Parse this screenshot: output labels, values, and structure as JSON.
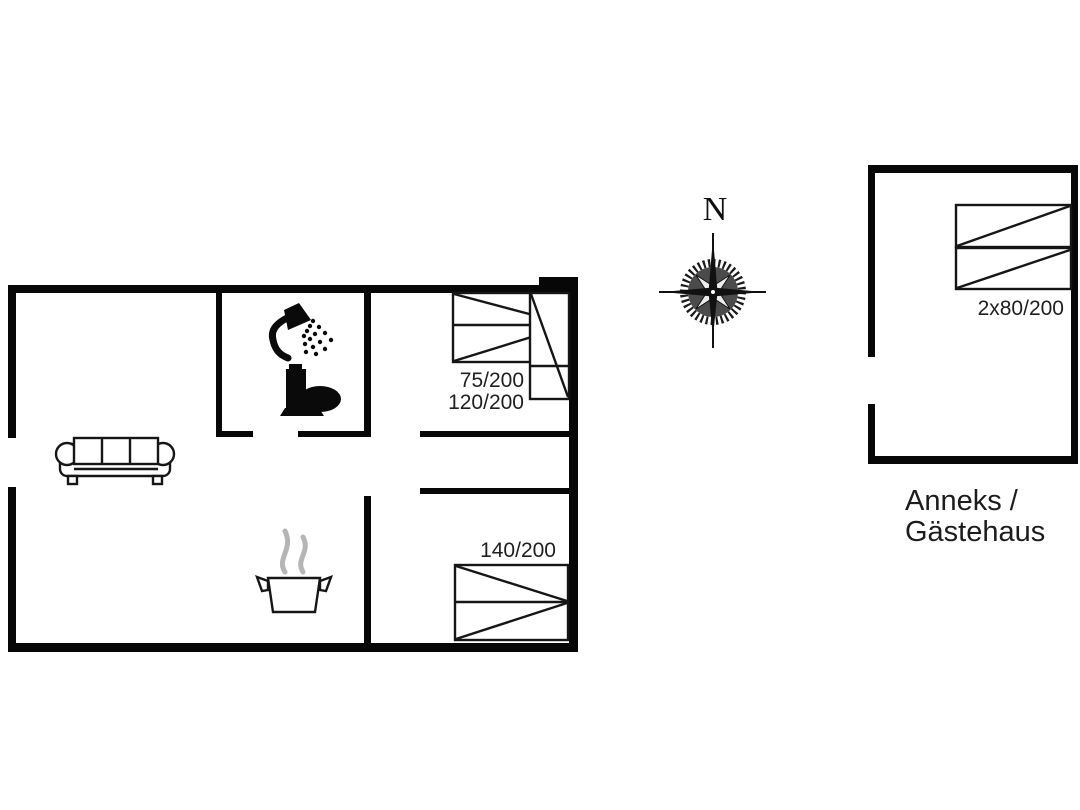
{
  "compass": {
    "north_label": "N"
  },
  "main_house": {
    "bedroom1": {
      "bed_labels": [
        "75/200",
        "120/200"
      ]
    },
    "bedroom2": {
      "bed_label": "140/200"
    }
  },
  "annex": {
    "bed_label": "2x80/200",
    "caption": [
      "Anneks /",
      "Gästehaus"
    ]
  },
  "icons": {
    "bathroom": [
      "shower-icon",
      "toilet-icon"
    ],
    "kitchen": [
      "cooking-pot-icon",
      "steam-icon"
    ],
    "living_room": [
      "sofa-icon"
    ],
    "navigation": [
      "compass-rose-icon"
    ]
  },
  "colors": {
    "background": "#ffffff",
    "wall": "#070707",
    "line": "#161616",
    "steam_gray": "#b5b5b5",
    "text": "#1f1f1f"
  }
}
